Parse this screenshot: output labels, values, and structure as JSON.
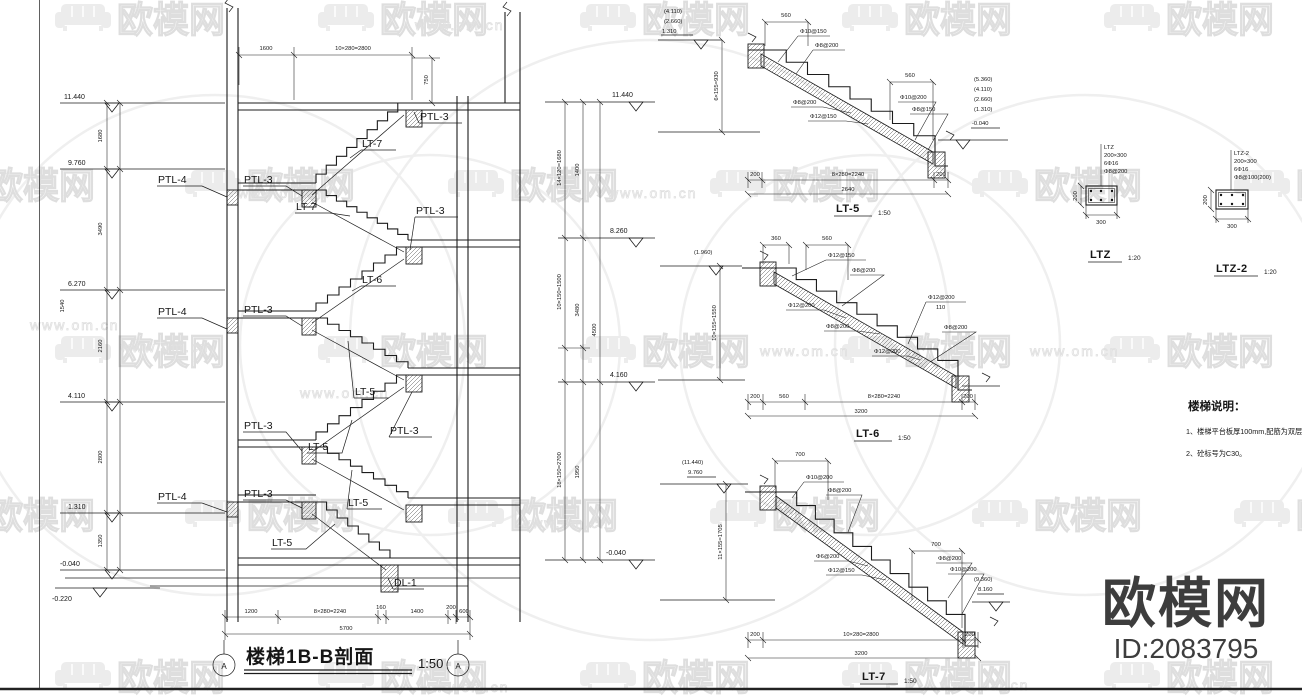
{
  "watermark": {
    "brand": "欧模网",
    "site": "www.om.cn"
  },
  "logo": {
    "brand": "欧模网",
    "id_text": "ID:2083795"
  },
  "section": {
    "title": "楼梯1B-B剖面",
    "scale": "1:50",
    "axis": "A",
    "levels_left": [
      "11.440",
      "9.760",
      "6.270",
      "4.110",
      "1.310",
      "-0.040",
      "-0.220"
    ],
    "dims_left": [
      "1680",
      "3490",
      "2160",
      "2800",
      "1350"
    ],
    "dim_left_extra": "1540",
    "dims_top": [
      "1600",
      "10×280=2800"
    ],
    "dim_top_right": "750",
    "dims_bottom": [
      "1200",
      "8×280=2240",
      "160",
      "1400",
      "200",
      "600"
    ],
    "dim_bottom_total": "5700",
    "levels_right": [
      "11.440",
      "8.260",
      "4.160",
      "-0.040"
    ],
    "dims_right_a": [
      "14×120=1680",
      "10×150=1500",
      "18×150=2700"
    ],
    "dims_right_b": [
      "1400",
      "3480",
      "1950"
    ],
    "dims_right_c": "4500",
    "ptl4": "PTL-4",
    "ptl3": "PTL-3",
    "lt7": "LT-7",
    "lt6": "LT-6",
    "lt5": "LT-5",
    "dl1": "DL-1"
  },
  "lt5": {
    "name": "LT-5",
    "scale": "1:50",
    "elev_left": [
      "(4.110)",
      "(2.660)",
      "1.310"
    ],
    "elev_right": [
      "(5.360)",
      "(4.110)",
      "(2.660)",
      "(1.310)"
    ],
    "elev_right_low": "-0.040",
    "dim_v": "6×155=930",
    "dim_top": "560",
    "dim_right": "560",
    "rebar_tl": [
      "Φ10@150",
      "Φ8@200"
    ],
    "rebar_mid": [
      "Φ8@200",
      "Φ12@150"
    ],
    "rebar_r": [
      "Φ10@200",
      "Φ8@150"
    ],
    "dims_bottom": [
      "200",
      "8×280=2240",
      "200"
    ],
    "dim_total": "2640"
  },
  "lt6": {
    "name": "LT-6",
    "scale": "1:50",
    "elev_left": "(1.960)",
    "dims_top": [
      "360",
      "560"
    ],
    "dim_v": "10×155=1550",
    "rebar_tl": [
      "Φ12@150",
      "Φ8@200"
    ],
    "rebar_mid": [
      "Φ12@200",
      "Φ8@200"
    ],
    "rebar_r": [
      "Φ12@200",
      "110",
      "Φ8@200"
    ],
    "rebar_b": "Φ12@200",
    "dims_bottom": [
      "200",
      "560",
      "8×280=2240",
      "200"
    ],
    "dim_total": "3200"
  },
  "lt7": {
    "name": "LT-7",
    "scale": "1:50",
    "elev_left": [
      "(11.440)",
      "9.760"
    ],
    "elev_right": [
      "(9.360)",
      "8.160"
    ],
    "dim_top": "700",
    "dim_right": "700",
    "dim_v": "11×155=1705",
    "rebar_tl": [
      "Φ10@200",
      "Φ8@200"
    ],
    "rebar_mid": [
      "Φ6@200",
      "Φ12@150"
    ],
    "rebar_r": [
      "Φ8@200",
      "Φ10@200"
    ],
    "dims_bottom": [
      "200",
      "10×280=2800",
      "200"
    ],
    "dim_total": "3200"
  },
  "ltz": {
    "label": "LTZ",
    "scale": "1:20",
    "spec": [
      "LTZ",
      "200×300",
      "6Φ16",
      "Φ8@200"
    ],
    "dim_w": "300",
    "dim_h": "200"
  },
  "ltz2": {
    "label": "LTZ-2",
    "scale": "1:20",
    "spec": [
      "LTZ-2",
      "200×300",
      "6Φ16",
      "Φ8@100(200)"
    ],
    "dim_w": "300",
    "dim_h": "200"
  },
  "notes": {
    "title": "楼梯说明：",
    "items": [
      "1、楼梯平台板厚100mm,配筋为双层双向。",
      "2、砼标号为C30。"
    ]
  }
}
